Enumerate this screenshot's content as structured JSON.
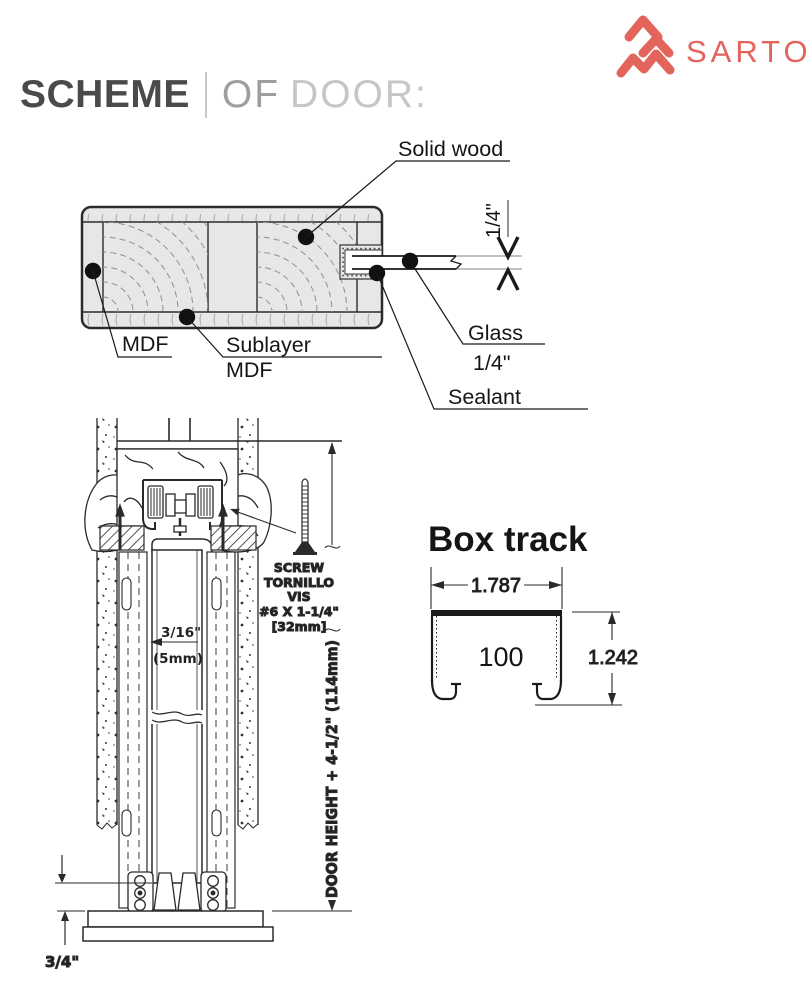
{
  "header": {
    "title_primary": "SCHEME",
    "title_of": "OF",
    "title_secondary": "DOOR:",
    "brand": "SARTO"
  },
  "door_section": {
    "labels": {
      "solid_wood": "Solid wood",
      "mdf": "MDF",
      "sublayer_line1": "Sublayer",
      "sublayer_line2": "MDF",
      "glass_line1": "Glass",
      "glass_line2": "1/4\"",
      "sealant": "Sealant",
      "glass_thickness": "1/4\""
    }
  },
  "mechanism": {
    "gap_dim_line1": "3/16\"",
    "gap_dim_line2": "(5mm)",
    "screw_note": [
      "SCREW",
      "TORNILLO",
      "VIS",
      "#6 X 1-1/4\"",
      "[32mm]"
    ],
    "height_dim": "DOOR HEIGHT + 4-1/2\" (114mm)",
    "floor_clearance": "3/4\""
  },
  "box_track": {
    "title": "Box track",
    "width_dim": "1.787",
    "inner_label": "100",
    "height_dim": "1.242"
  },
  "colors": {
    "accent": "#E2645B",
    "line": "#2A2A2A",
    "door_fill": "#E7E7E7",
    "title_dark": "#4A4A4A",
    "title_light": "#C6C6C6"
  }
}
